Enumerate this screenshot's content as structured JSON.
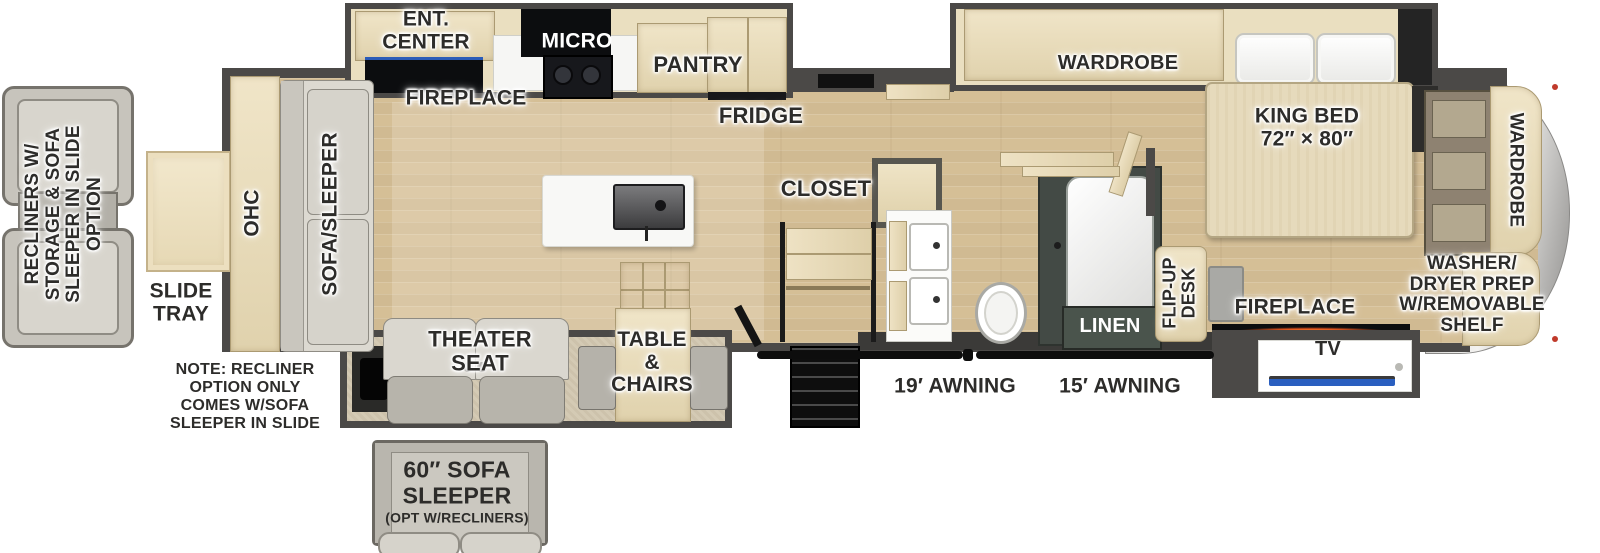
{
  "rear": {
    "recliner_option": "RECLINERS W/\nSTORAGE & SOFA\nSLEEPER IN SLIDE\nOPTION",
    "slide_tray": "SLIDE\nTRAY",
    "note": "NOTE: RECLINER\nOPTION ONLY\nCOMES W/SOFA\nSLEEPER IN SLIDE",
    "ohc": "OHC",
    "sofa_sleeper": "SOFA/SLEEPER"
  },
  "kitchen": {
    "ent_center": "ENT.\nCENTER",
    "fireplace": "FIREPLACE",
    "micro": "MICRO",
    "pantry": "PANTRY",
    "fridge": "FRIDGE"
  },
  "dinette": {
    "theater_seat": "THEATER\nSEAT",
    "table_chairs": "TABLE\n&\nCHAIRS"
  },
  "sofa_option": {
    "line1": "60″ SOFA",
    "line2": "SLEEPER",
    "line3": "(OPT W/RECLINERS)"
  },
  "bath": {
    "closet": "CLOSET",
    "linen": "LINEN"
  },
  "awnings": {
    "awning_19": "19′ AWNING",
    "awning_15": "15′ AWNING"
  },
  "bedroom": {
    "wardrobe_slide": "WARDROBE",
    "king_bed": "KING BED\n72″ × 80″",
    "flip_up_desk": "FLIP-UP\nDESK",
    "fireplace": "FIREPLACE",
    "tv": "TV",
    "wardrobe_front": "WARDROBE",
    "washer_dryer": "WASHER/\nDRYER PREP\nW/REMOVABLE\nSHELF"
  },
  "colors": {
    "wall": "#4b4947",
    "floor": "#d8c39c",
    "cabinet_wood": "#e8dcbc",
    "flame_accent": "#ff8c1a",
    "fireplace_blue": "#2b5cb8",
    "tv_blue": "#2a5fc0",
    "front_cap": "#c9c8c6",
    "linen_cabinet": "#4a544c"
  }
}
